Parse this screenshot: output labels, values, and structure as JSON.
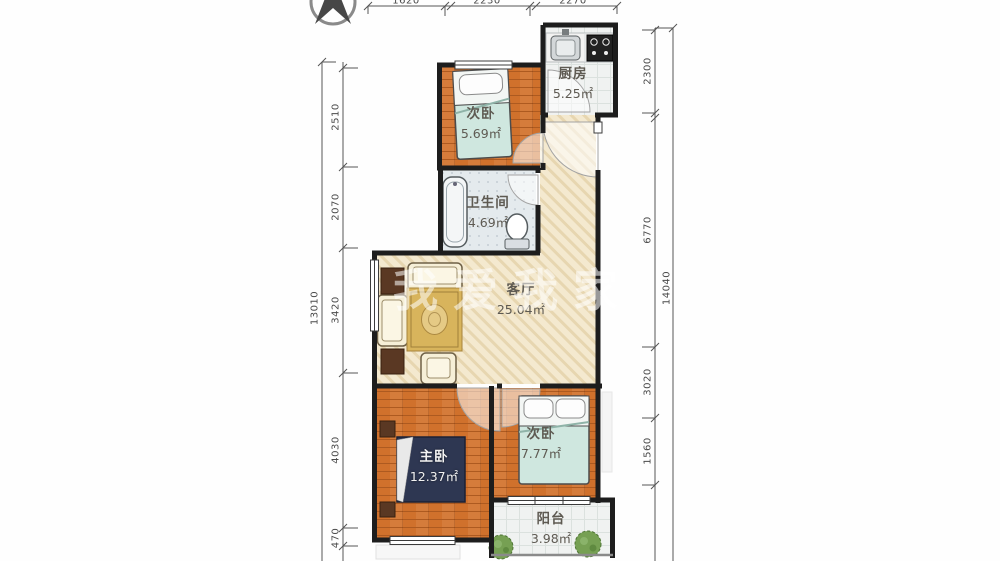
{
  "plan": {
    "watermark": "我爱我家",
    "rooms": [
      {
        "id": "kitchen",
        "name": "厨房",
        "area": "5.25㎡"
      },
      {
        "id": "bedroom-top",
        "name": "次卧",
        "area": "5.69㎡"
      },
      {
        "id": "bathroom",
        "name": "卫生间",
        "area": "4.69㎡"
      },
      {
        "id": "living-room",
        "name": "客厅",
        "area": "25.04㎡"
      },
      {
        "id": "master-bedroom",
        "name": "主卧",
        "area": "12.37㎡"
      },
      {
        "id": "bedroom-right",
        "name": "次卧",
        "area": "7.77㎡"
      },
      {
        "id": "balcony",
        "name": "阳台",
        "area": "3.98㎡"
      }
    ],
    "dimensions": {
      "top": [
        "1620",
        "2230",
        "2270"
      ],
      "left": {
        "total": "13010",
        "segments": [
          "2510",
          "2070",
          "3420",
          "4030",
          "470"
        ]
      },
      "right": {
        "total": "14040",
        "segments": [
          "2300",
          "6770",
          "3020",
          "1560"
        ]
      }
    },
    "colors": {
      "wall": "#1d1d1d",
      "wood_floor": "#d0712c",
      "living_floor": "#f4e9cf",
      "bed_teal": "#d5eae2",
      "master_bed": "#2e3752",
      "rug_gold": "#d8b45c"
    }
  }
}
